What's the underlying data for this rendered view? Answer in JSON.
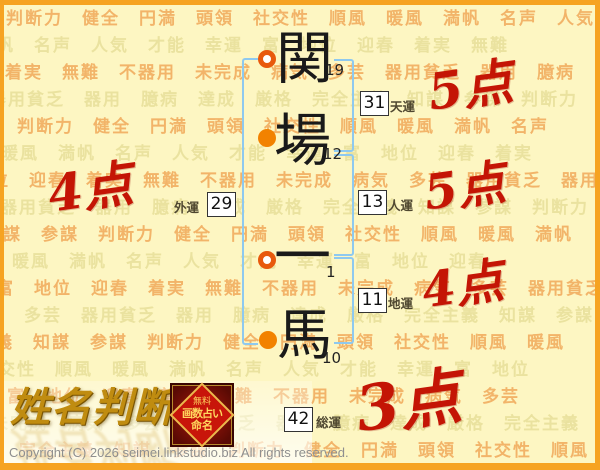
{
  "background": {
    "words": [
      "判断力",
      "健全",
      "円満",
      "頭領",
      "社交性",
      "順風",
      "暖風",
      "満帆",
      "名声",
      "人気",
      "才能",
      "幸運",
      "富",
      "地位",
      "迎春",
      "着実",
      "無難",
      "不器用",
      "未完成",
      "病気",
      "多芸",
      "器用貧乏",
      "器用",
      "臆病",
      "達成",
      "厳格",
      "完全主義",
      "知謀",
      "参謀"
    ]
  },
  "name": {
    "characters": [
      {
        "char": "関",
        "strokes": "19",
        "marker": "hollow"
      },
      {
        "char": "場",
        "strokes": "12",
        "marker": "filled"
      },
      {
        "char": "一",
        "strokes": "1",
        "marker": "hollow"
      },
      {
        "char": "馬",
        "strokes": "10",
        "marker": "filled"
      }
    ]
  },
  "fortunes": {
    "tenun": {
      "value": "31",
      "label": "天運",
      "score": "5点"
    },
    "jinun": {
      "value": "13",
      "label": "人運",
      "score": "5点"
    },
    "chiun": {
      "value": "11",
      "label": "地運",
      "score": "4点"
    },
    "gaiun": {
      "value": "29",
      "label": "外運",
      "score": "4点"
    },
    "souun": {
      "value": "42",
      "label": "総運",
      "score": "3点"
    }
  },
  "logo": {
    "title": "姓名判断",
    "badge": {
      "line1": "無料",
      "line2": "画数占い",
      "line3": "命名"
    }
  },
  "footer": {
    "copyright": "Copyright (C) 2026 seimei.linkstudio.biz All rights reserved."
  },
  "colors": {
    "score_red": "#c41505",
    "bracket_blue": "#8ec9ef",
    "marker_orange": "#f28200",
    "frame_orange": "#f6a321",
    "page_background": "#fdf6c2",
    "background_word_orange": "#f2b469",
    "background_word_pale": "#eae29f"
  }
}
